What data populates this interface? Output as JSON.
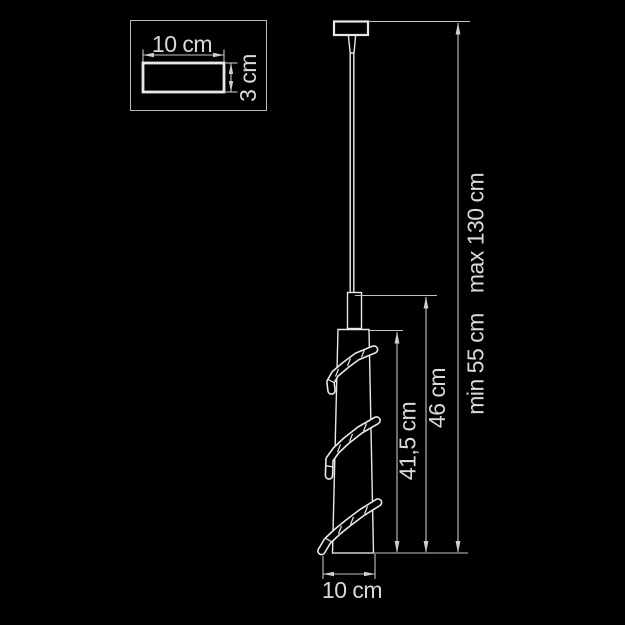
{
  "diagram": {
    "detail_box": {
      "width_label": "10 cm",
      "depth_label": "3 cm"
    },
    "dimensions": {
      "shade_height_label": "41,5 cm",
      "fixture_height_label": "46 cm",
      "min_suspension_label": "min 55 cm",
      "max_suspension_label": "max 130 cm",
      "shade_diameter_label": "10 cm"
    },
    "colors": {
      "background": "#000000",
      "dimension_line": "#c4c4c4",
      "object_line": "#e8e8e8",
      "text": "#d9d9d9"
    }
  }
}
